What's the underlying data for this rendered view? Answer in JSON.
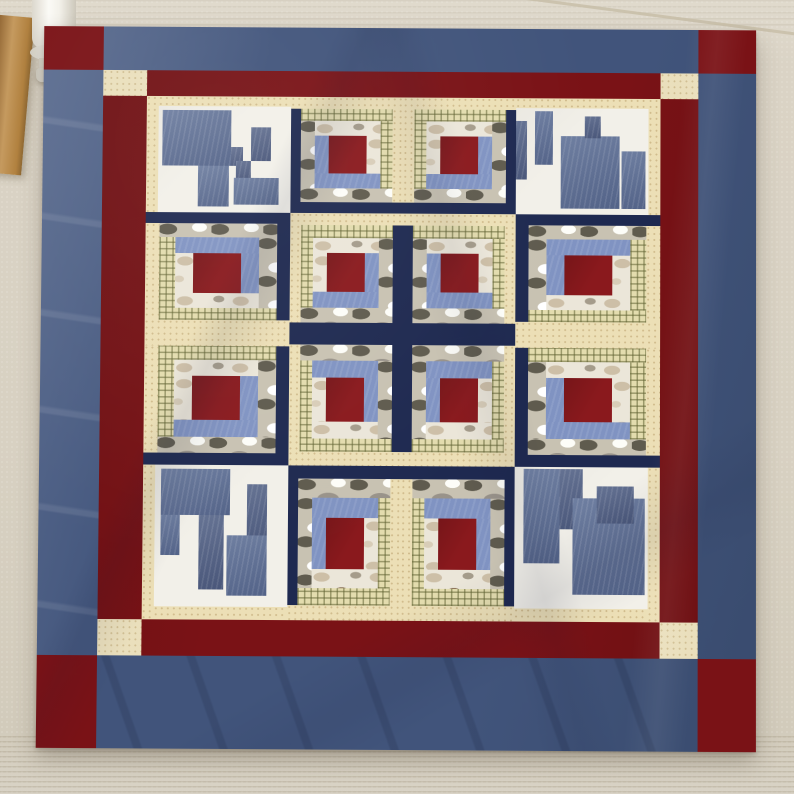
{
  "scene": {
    "type": "photograph",
    "subject": "Handmade log-cabin patchwork quilt laid flat on a beige carpeted floor, photographed from above at a slight angle",
    "background": {
      "carpet_color": "#d8d1c2",
      "carpet_rib_color": "#968a70",
      "wood_furniture_color": "#b9884d",
      "white_furniture_leg_color": "#f5f3ed"
    }
  },
  "quilt": {
    "borders": {
      "outer_color": "#41547b",
      "outer_left_light": "#5e6f92",
      "outer_cornerstone_red": "#7a1216",
      "inner_border_red": "#7a1216",
      "inner_cornerstone_cream": "#eadfbc"
    },
    "fabrics": {
      "navy": "#1e2950",
      "cream": "#ecdfb6",
      "gingham_base": "#e3dcae",
      "gingham_line": "rgba(96,98,50,0.55)",
      "camo_base": "#c8c2b2",
      "camo_dark": "#5f5b4e",
      "camo_mid": "#99938a",
      "white_camo_base": "#ebe6d9",
      "light_blue": "#8093c2",
      "center_red": "#8a191d",
      "denim_mid": "#5e7096",
      "denim_dark": "#536286",
      "denim_light": "#7e90b6",
      "white_field": "#f2f0e9"
    },
    "fabric_names": [
      "dark red center",
      "light denim blue L",
      "white/tan camouflage",
      "grey camouflage",
      "olive gingham check",
      "speckled cream",
      "navy",
      "chambray denim",
      "white"
    ],
    "grid": {
      "rows": 4,
      "cols": 4,
      "blocks": [
        [
          "stair-tl",
          "logcabin-bl",
          "logcabin-br",
          "stair-tr"
        ],
        [
          "logcabin-tr",
          "logcabin-br",
          "logcabin-bl",
          "logcabin-tl"
        ],
        [
          "logcabin-br",
          "logcabin-tr",
          "logcabin-tl",
          "logcabin-bl"
        ],
        [
          "stair-bl",
          "logcabin-tl",
          "logcabin-tr",
          "stair-br"
        ]
      ],
      "logcabin_note": "suffix = corner holding the dark rounds (navy / grey camo / light blue) around the red center; opposite corner holds cream / gingham / white-camo",
      "stair_note": "corner blocks are white fields with stepped chambray-denim shapes and cream strips on the two outward sides"
    }
  }
}
